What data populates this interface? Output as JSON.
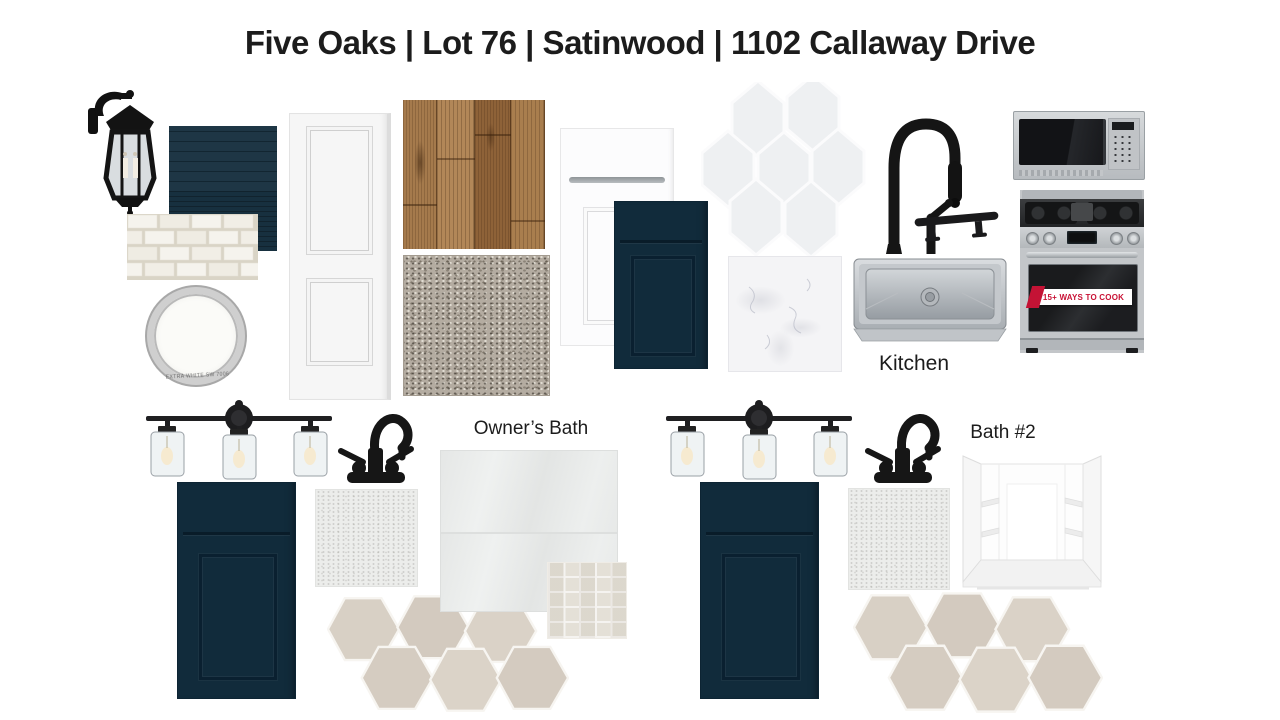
{
  "title": "Five Oaks | Lot 76 | Satinwood | 1102 Callaway Drive",
  "sections": {
    "kitchen": {
      "label": "Kitchen"
    },
    "owners_bath": {
      "label": "Owner’s Bath"
    },
    "bath2": {
      "label": "Bath #2"
    }
  },
  "range": {
    "banner": "15+ WAYS TO COOK"
  },
  "paint_lid": {
    "caption": "EXTRA WHITE SW 7006"
  },
  "colors": {
    "cabinet_navy": "#112b3b",
    "siding_navy": "#17303f",
    "banner_red": "#c81034",
    "stainless": "#c3c6c9",
    "hex_tile_beige": "#d6cec3",
    "wood_brown": "#a57a4c"
  }
}
